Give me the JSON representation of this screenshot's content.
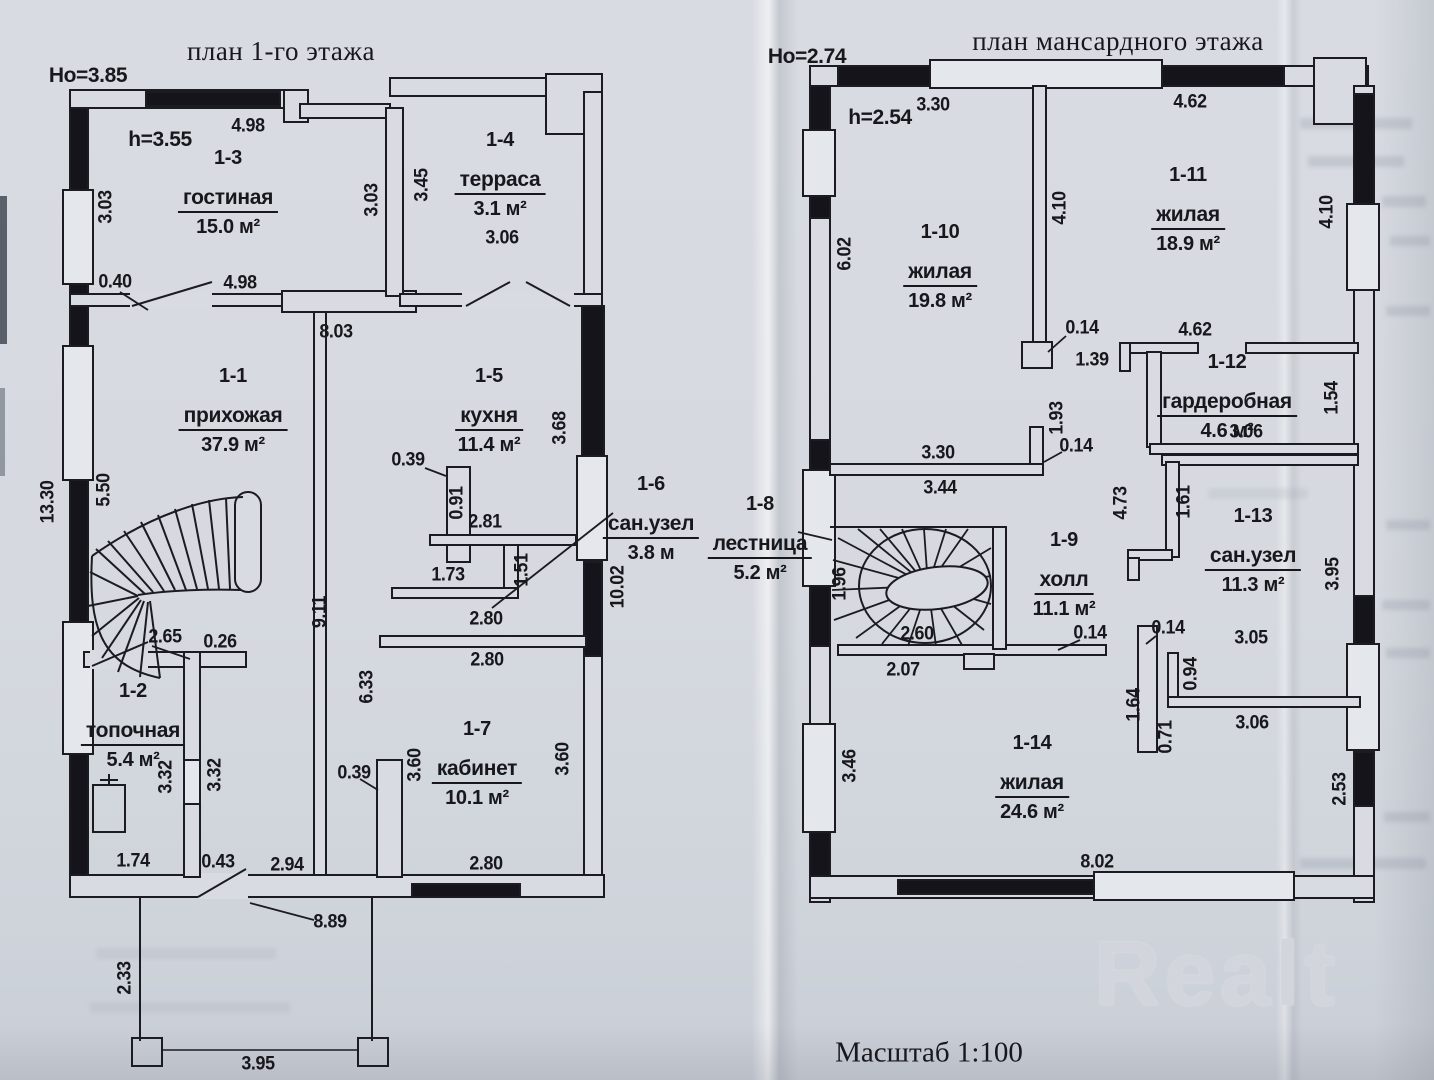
{
  "left_plan": {
    "title": "план 1-го этажа",
    "outer_height": "Но=3.85",
    "inner_height": "h=3.55",
    "rooms": [
      {
        "id": "1-3",
        "name": "гостиная",
        "area": "15.0 м²"
      },
      {
        "id": "1-4",
        "name": "терраса",
        "area": "3.1 м²"
      },
      {
        "id": "1-1",
        "name": "прихожая",
        "area": "37.9 м²"
      },
      {
        "id": "1-5",
        "name": "кухня",
        "area": "11.4 м²"
      },
      {
        "id": "1-6",
        "name": "сан.узел",
        "area": "3.8 м"
      },
      {
        "id": "1-2",
        "name": "топочная",
        "area": "5.4 м²"
      },
      {
        "id": "1-7",
        "name": "кабинет",
        "area": "10.1 м²"
      }
    ],
    "dims": [
      "4.98",
      "3.03",
      "3.03",
      "3.45",
      "3.06",
      "0.40",
      "4.98",
      "8.03",
      "3.68",
      "13.30",
      "5.50",
      "9.11",
      "0.39",
      "0.91",
      "2.81",
      "1.73",
      "1.51",
      "10.02",
      "2.80",
      "2.80",
      "2.65",
      "0.26",
      "3.32",
      "3.32",
      "6.33",
      "0.39",
      "3.60",
      "3.60",
      "2.80",
      "1.74",
      "0.43",
      "2.94",
      "8.89",
      "2.33",
      "3.95"
    ]
  },
  "right_plan": {
    "title": "план мансардного этажа",
    "outer_height": "Но=2.74",
    "inner_height": "h=2.54",
    "rooms": [
      {
        "id": "1-10",
        "name": "жилая",
        "area": "19.8 м²"
      },
      {
        "id": "1-11",
        "name": "жилая",
        "area": "18.9 м²"
      },
      {
        "id": "1-12",
        "name": "гардеробная",
        "area": "4.6 м²"
      },
      {
        "id": "1-8",
        "name": "лестница",
        "area": "5.2 м²"
      },
      {
        "id": "1-9",
        "name": "холл",
        "area": "11.1 м²"
      },
      {
        "id": "1-13",
        "name": "сан.узел",
        "area": "11.3 м²"
      },
      {
        "id": "1-14",
        "name": "жилая",
        "area": "24.6 м²"
      }
    ],
    "dims": [
      "3.30",
      "4.62",
      "6.02",
      "4.10",
      "4.10",
      "0.14",
      "1.39",
      "4.62",
      "1.54",
      "3.06",
      "1.93",
      "0.14",
      "3.30",
      "3.44",
      "4.73",
      "1.61",
      "1.96",
      "2.60",
      "0.14",
      "2.07",
      "0.14",
      "3.05",
      "0.94",
      "1.64",
      "0.71",
      "3.06",
      "3.95",
      "3.46",
      "8.02",
      "2.53"
    ]
  },
  "footer": {
    "scale_label": "Масштаб 1:100",
    "watermark": "Realt"
  }
}
